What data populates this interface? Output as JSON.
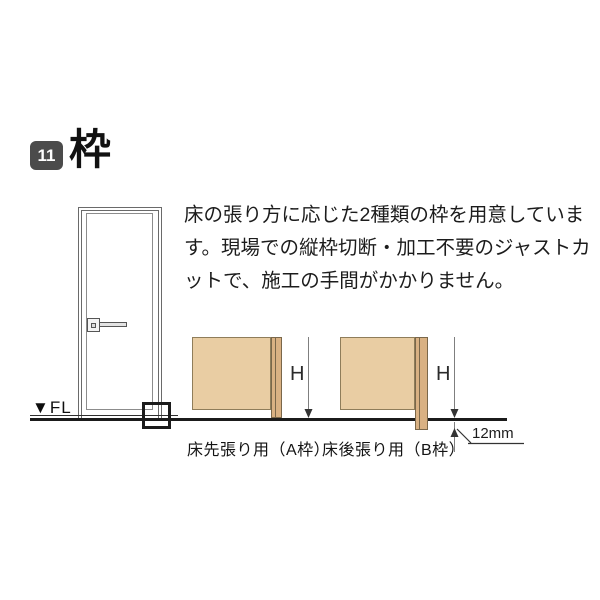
{
  "header": {
    "badge_number": "11",
    "title": "枠"
  },
  "intro": {
    "text": "床の張り方に応じた2種類の枠を用意しています。現場での縦枠切断・加工不要のジャストカットで、施工の手間がかかりません。"
  },
  "door_illustration": {
    "fl_label": "▼FL"
  },
  "diagrams": [
    {
      "id": "A",
      "h_label": "H",
      "caption": "床先張り用（A枠）"
    },
    {
      "id": "B",
      "h_label": "H",
      "caption": "床後張り用（B枠）",
      "offset_label": "12mm"
    }
  ],
  "colors": {
    "page_bg": "#ffffff",
    "badge_bg": "#4b4b4b",
    "wall_fill": "#e9cda3",
    "wall_border": "#8f7d5a",
    "frame_fill": "#d9b183",
    "floor_line": "#1b1b1b"
  }
}
